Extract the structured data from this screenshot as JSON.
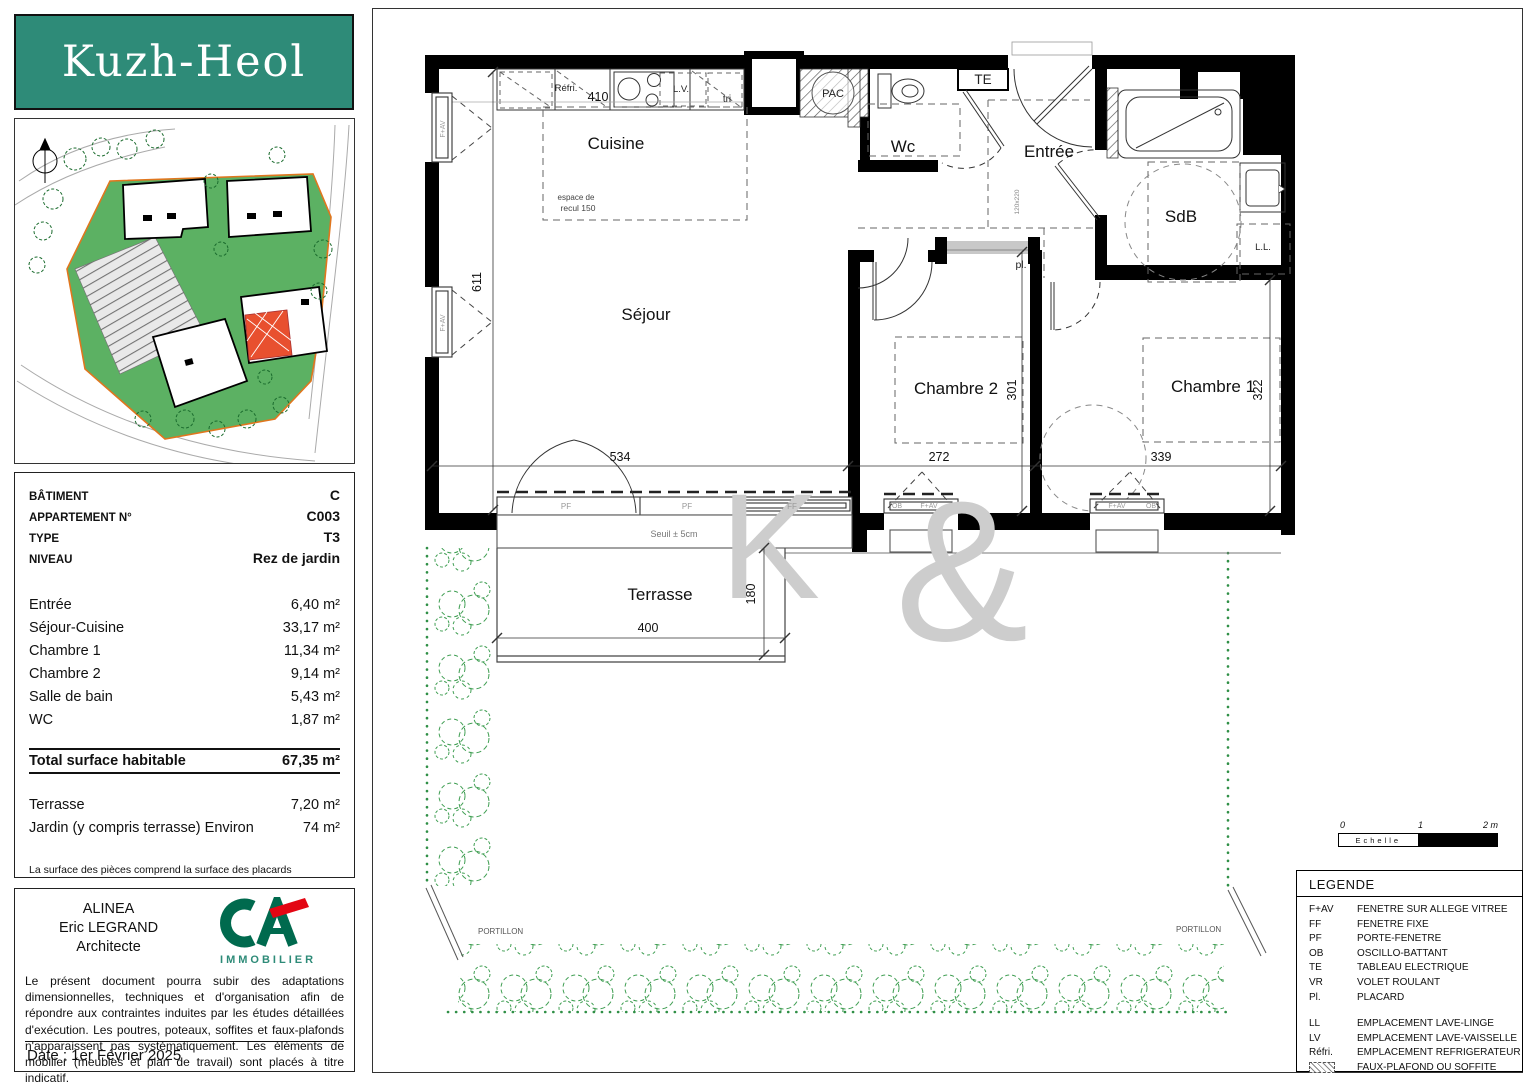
{
  "colors": {
    "brand_teal": "#2E8B78",
    "ca_green": "#006A4E",
    "ca_red": "#E30613",
    "site_green": "#5CB163",
    "boundary_orange": "#E0761E",
    "hedge_green": "#3F9E52"
  },
  "logo": {
    "title": "Kuzh-Heol"
  },
  "info": {
    "meta": [
      {
        "label": "BÂTIMENT",
        "value": "C"
      },
      {
        "label": "APPARTEMENT N°",
        "value": "C003"
      },
      {
        "label": "TYPE",
        "value": "T3"
      },
      {
        "label": "NIVEAU",
        "value": "Rez de jardin"
      }
    ],
    "areas": [
      {
        "label": "Entrée",
        "value": "6,40 m²"
      },
      {
        "label": "Séjour-Cuisine",
        "value": "33,17 m²"
      },
      {
        "label": "Chambre 1",
        "value": "11,34 m²"
      },
      {
        "label": "Chambre 2",
        "value": "9,14 m²"
      },
      {
        "label": "Salle de bain",
        "value": "5,43 m²"
      },
      {
        "label": "WC",
        "value": "1,87 m²"
      }
    ],
    "total_label": "Total surface habitable",
    "total_value": "67,35 m²",
    "outdoor": [
      {
        "label": "Terrasse",
        "value": "7,20 m²"
      },
      {
        "label": "Jardin (y compris terrasse) Environ",
        "value": "74 m²"
      }
    ],
    "note": "La surface des pièces comprend la surface des placards"
  },
  "architect": {
    "line1": "ALINEA",
    "line2": "Eric LEGRAND",
    "line3": "Architecte",
    "brand": "IMMOBILIER",
    "disclaimer": "Le présent document pourra subir des adaptations dimensionnelles, techniques et d'organisation afin de répondre aux contraintes induites par les études détaillées d'exécution. Les poutres, poteaux, soffites et faux-plafonds n'apparaissent pas systématiquement. Les éléments de mobilier (meubles et plan de travail) sont placés à titre indicatif.",
    "date": "Date : 1er Février 2025"
  },
  "plan": {
    "rooms": {
      "cuisine": "Cuisine",
      "wc": "Wc",
      "entree": "Entrée",
      "sdb": "SdB",
      "sejour": "Séjour",
      "chambre2": "Chambre 2",
      "chambre1": "Chambre 1",
      "terrasse": "Terrasse"
    },
    "labels": {
      "refri": "Réfri.",
      "lv": "L.V.",
      "tri": "tri",
      "pac": "PAC",
      "te": "TE",
      "pl": "pl.",
      "ll": "L.L.",
      "door_size": "120x220",
      "espace_line1": "espace de",
      "espace_line2": "recul 150",
      "seuil": "Seuil ± 5cm",
      "pf": "PF",
      "ff": "FF",
      "fav": "F+AV",
      "ob": "OB",
      "portillon": "PORTILLON"
    },
    "dims": {
      "kitchen": "410",
      "sejour_h": "611",
      "sejour_w": "534",
      "ch2_w": "272",
      "ch2_h": "301",
      "ch1_w": "339",
      "ch1_h": "322",
      "terrasse_w": "400",
      "terrasse_h": "180"
    },
    "watermark_k": "K",
    "watermark_amp": "&"
  },
  "scalebar": {
    "t0": "0",
    "t1": "1",
    "t2": "2 m",
    "label": "Echelle"
  },
  "legend": {
    "title": "LEGENDE",
    "rows": [
      {
        "abbr": "F+AV",
        "label": "FENETRE SUR ALLEGE VITREE"
      },
      {
        "abbr": "FF",
        "label": "FENETRE FIXE"
      },
      {
        "abbr": "PF",
        "label": "PORTE-FENETRE"
      },
      {
        "abbr": "OB",
        "label": "OSCILLO-BATTANT"
      },
      {
        "abbr": "TE",
        "label": "TABLEAU ELECTRIQUE"
      },
      {
        "abbr": "VR",
        "label": "VOLET ROULANT"
      },
      {
        "abbr": "Pl.",
        "label": "PLACARD"
      }
    ],
    "rows2": [
      {
        "abbr": "LL",
        "label": "EMPLACEMENT LAVE-LINGE"
      },
      {
        "abbr": "LV",
        "label": "EMPLACEMENT LAVE-VAISSELLE"
      },
      {
        "abbr": "Réfri.",
        "label": "EMPLACEMENT REFRIGERATEUR"
      }
    ],
    "hatch_label": "FAUX-PLAFOND OU SOFFITE"
  }
}
